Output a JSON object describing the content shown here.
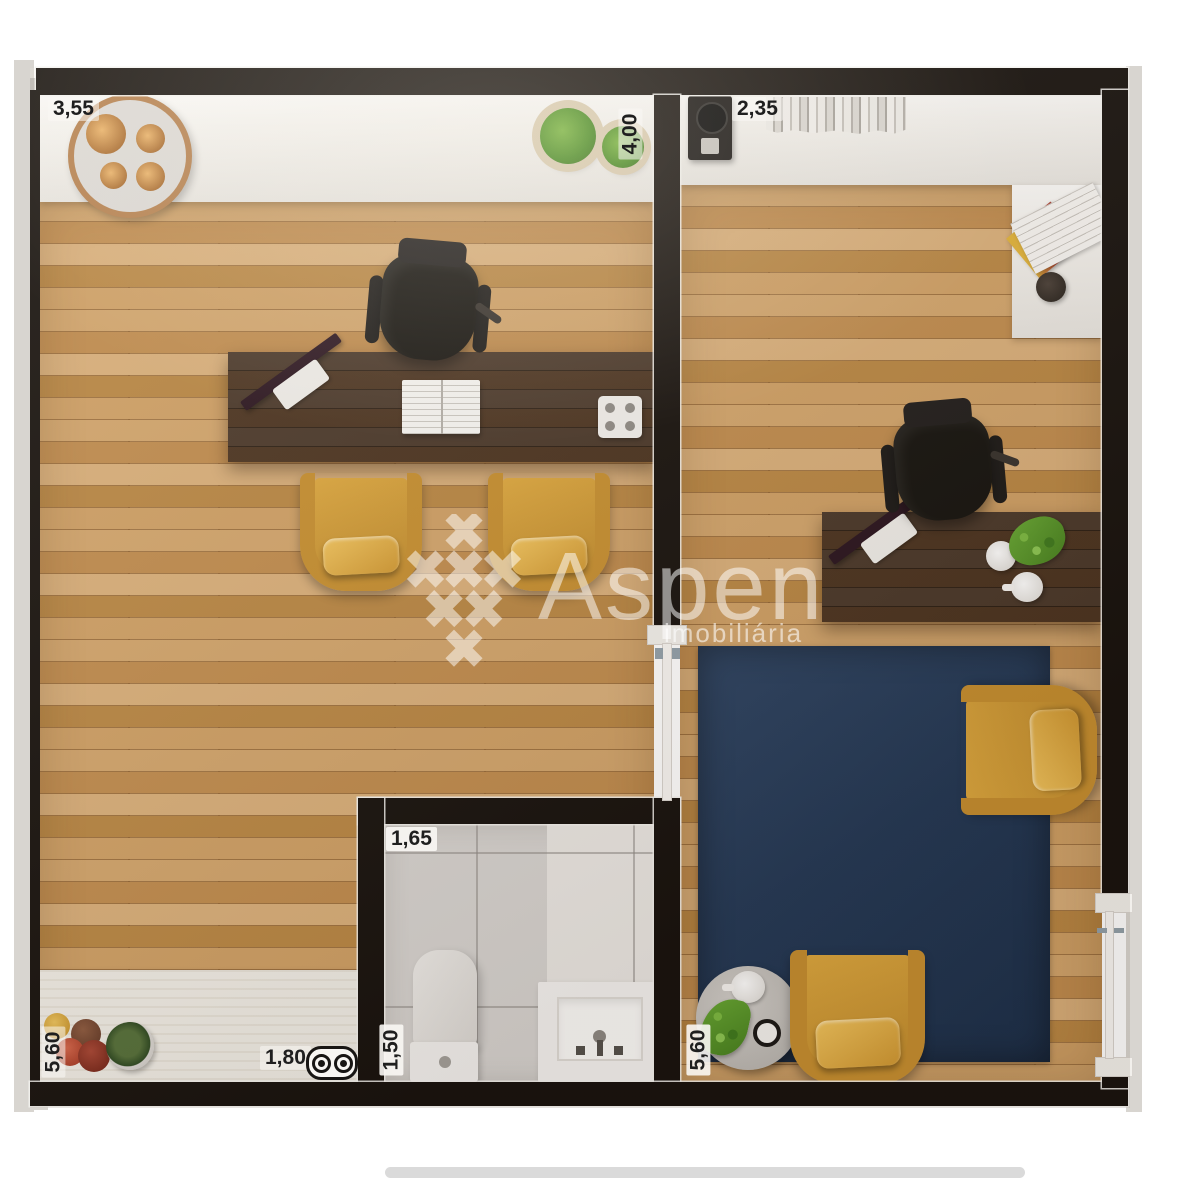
{
  "watermark": {
    "brand": "Aspen",
    "subtitle": "imobiliária"
  },
  "dimensions": {
    "left_room_width": "3,55",
    "left_room_side": "4,00",
    "right_room_width": "2,35",
    "bathroom_width": "1,65",
    "bathroom_depth": "1,50",
    "counter_length": "1,80",
    "left_room_depth": "5,60",
    "right_room_depth": "5,60"
  },
  "icons": {
    "cooktop": "double-burner-cooktop",
    "logo": "aspen-snowflake"
  },
  "palette": {
    "wall": "#17120e",
    "wood_floor": "#c9995e",
    "desk_wood": "#3f2c1d",
    "rug_navy": "#21395a",
    "armchair_mustard": "#d8a23c",
    "counter_white": "#f4f2ee",
    "tile_gray": "#d7d4d1"
  }
}
